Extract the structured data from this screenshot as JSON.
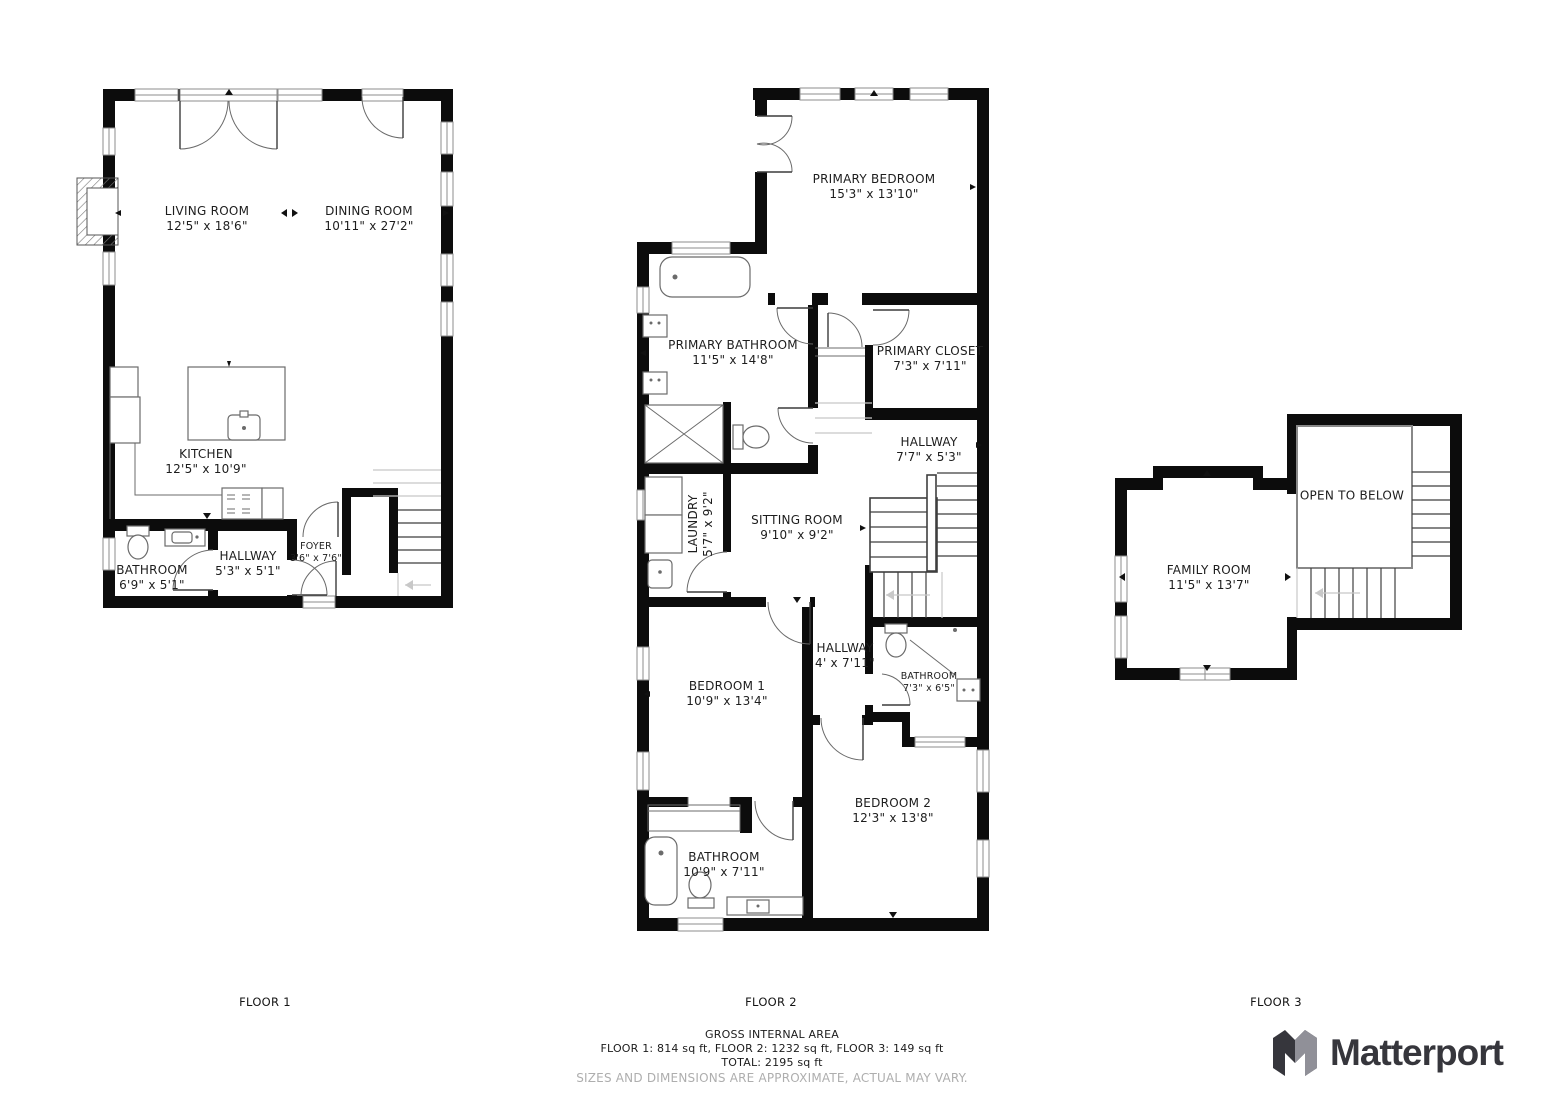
{
  "floors": [
    {
      "label": "FLOOR 1",
      "rooms": [
        {
          "name": "LIVING ROOM",
          "dims": "12'5\" x 18'6\""
        },
        {
          "name": "DINING ROOM",
          "dims": "10'11\" x 27'2\""
        },
        {
          "name": "KITCHEN",
          "dims": "12'5\" x 10'9\""
        },
        {
          "name": "BATHROOM",
          "dims": "6'9\" x 5'1\""
        },
        {
          "name": "HALLWAY",
          "dims": "5'3\" x 5'1\""
        },
        {
          "name": "FOYER",
          "dims": "3'6\" x 7'6\""
        }
      ]
    },
    {
      "label": "FLOOR 2",
      "rooms": [
        {
          "name": "PRIMARY BEDROOM",
          "dims": "15'3\" x 13'10\""
        },
        {
          "name": "PRIMARY BATHROOM",
          "dims": "11'5\" x 14'8\""
        },
        {
          "name": "PRIMARY CLOSET",
          "dims": "7'3\" x 7'11\""
        },
        {
          "name": "HALLWAY",
          "dims": "7'7\" x 5'3\""
        },
        {
          "name": "LAUNDRY",
          "dims": "5'7\" x 9'2\""
        },
        {
          "name": "SITTING ROOM",
          "dims": "9'10\" x 9'2\""
        },
        {
          "name": "HALLWAY",
          "dims": "4' x 7'11\""
        },
        {
          "name": "BATHROOM",
          "dims": "7'3\" x 6'5\""
        },
        {
          "name": "BEDROOM 1",
          "dims": "10'9\" x 13'4\""
        },
        {
          "name": "BEDROOM 2",
          "dims": "12'3\" x 13'8\""
        },
        {
          "name": "BATHROOM",
          "dims": "10'9\" x 7'11\""
        }
      ]
    },
    {
      "label": "FLOOR 3",
      "rooms": [
        {
          "name": "FAMILY ROOM",
          "dims": "11'5\" x 13'7\""
        },
        {
          "name": "OPEN TO BELOW",
          "dims": ""
        }
      ]
    }
  ],
  "footer": {
    "area_title": "GROSS INTERNAL AREA",
    "area_breakdown": "FLOOR 1: 814 sq ft, FLOOR 2: 1232 sq ft, FLOOR 3: 149 sq ft",
    "area_total": "TOTAL: 2195 sq ft",
    "disclaimer": "SIZES AND DIMENSIONS ARE APPROXIMATE, ACTUAL MAY VARY."
  },
  "brand": {
    "name": "Matterport"
  },
  "colors": {
    "wall": "#0c0c0c",
    "fixture": "#6b6b6b",
    "window": "#8e8e8e",
    "stair_light": "#c8c8c8",
    "label": "#1d1d1d",
    "disclaimer": "#aeaeae",
    "brand_dark": "#36363c",
    "brand_gray": "#909098"
  }
}
